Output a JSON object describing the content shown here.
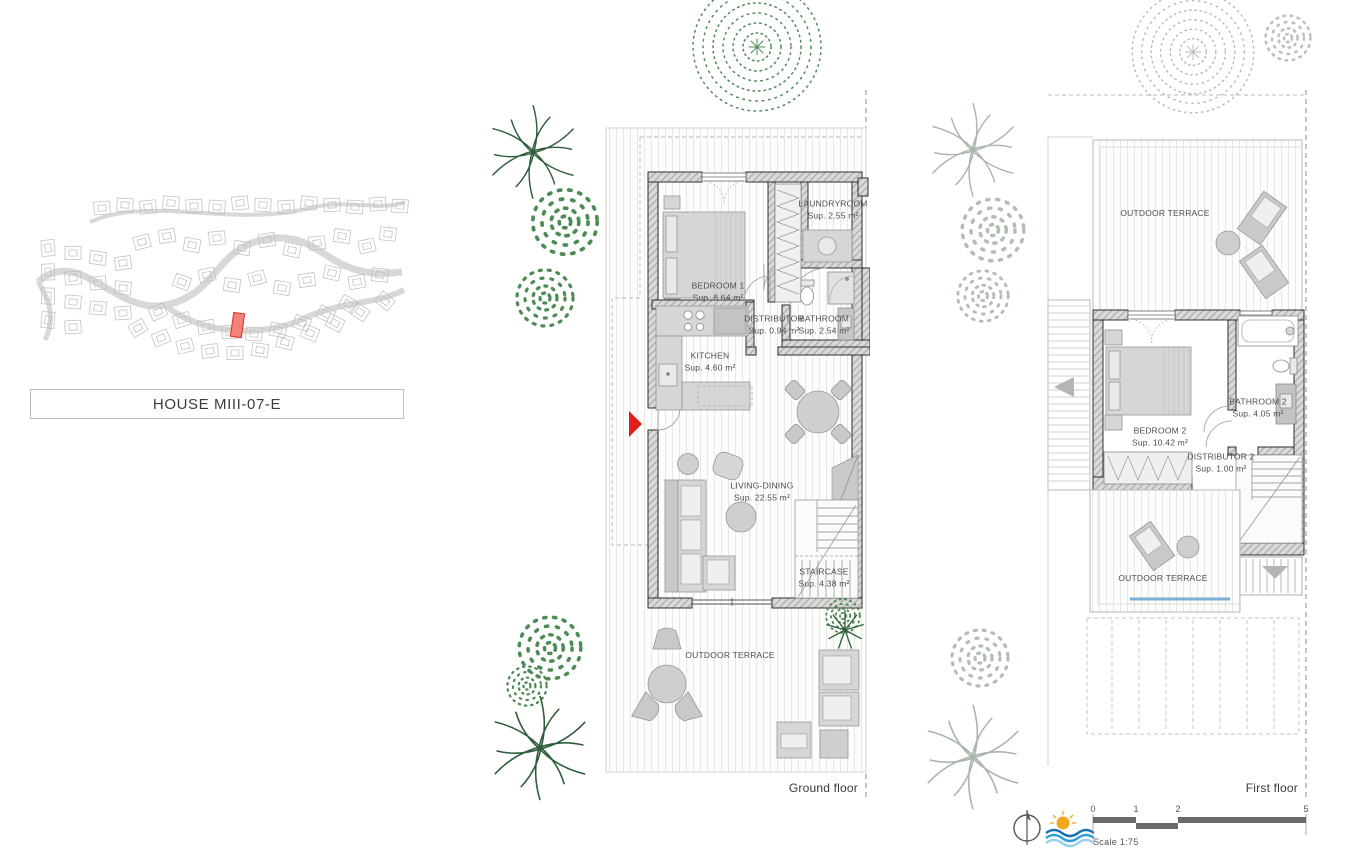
{
  "title": "HOUSE MIII-07-E",
  "site_plan": {
    "highlight_color": "#f2837b"
  },
  "floors": {
    "ground": {
      "caption": "Ground floor",
      "rooms": {
        "bedroom1": {
          "name": "BEDROOM 1",
          "area": "Sup. 8.64 m²"
        },
        "laundry": {
          "name": "LAUNDRYROOM",
          "area": "Sup. 2.55 m²"
        },
        "distributor": {
          "name": "DISTRIBUTOR",
          "area": "Sup. 0.94 m²"
        },
        "bathroom": {
          "name": "BATHROOM",
          "area": "Sup. 2.54 m²"
        },
        "kitchen": {
          "name": "KITCHEN",
          "area": "Sup. 4.60 m²"
        },
        "living": {
          "name": "LIVING-DINING",
          "area": "Sup. 22.55 m²"
        },
        "staircase": {
          "name": "STAIRCASE",
          "area": "Sup. 4.38 m²"
        },
        "terrace": {
          "name": "OUTDOOR TERRACE"
        }
      }
    },
    "first": {
      "caption": "First floor",
      "rooms": {
        "terrace_top": {
          "name": "OUTDOOR TERRACE"
        },
        "bedroom2": {
          "name": "BEDROOM 2",
          "area": "Sup. 10.42 m²"
        },
        "bathroom2": {
          "name": "BATHROOM 2",
          "area": "Sup. 4.05 m²"
        },
        "distributor2": {
          "name": "DISTRIBUTOR 2",
          "area": "Sup. 1.00 m²"
        },
        "terrace_bottom": {
          "name": "OUTDOOR TERRACE"
        }
      }
    }
  },
  "scale_bar": {
    "marks": [
      "0",
      "1",
      "2",
      "5"
    ],
    "label": "Scale 1:75"
  },
  "colors": {
    "highlight": "#e21b1b",
    "water_line": "#7bb0d6",
    "sun": "#f3a71c",
    "wave_dark": "#1a6fb5",
    "wave_mid": "#2d9fd8",
    "wave_light": "#9ad1ea",
    "vegetation_green": "#4d8b55",
    "vegetation_gray": "#b3beb3"
  }
}
